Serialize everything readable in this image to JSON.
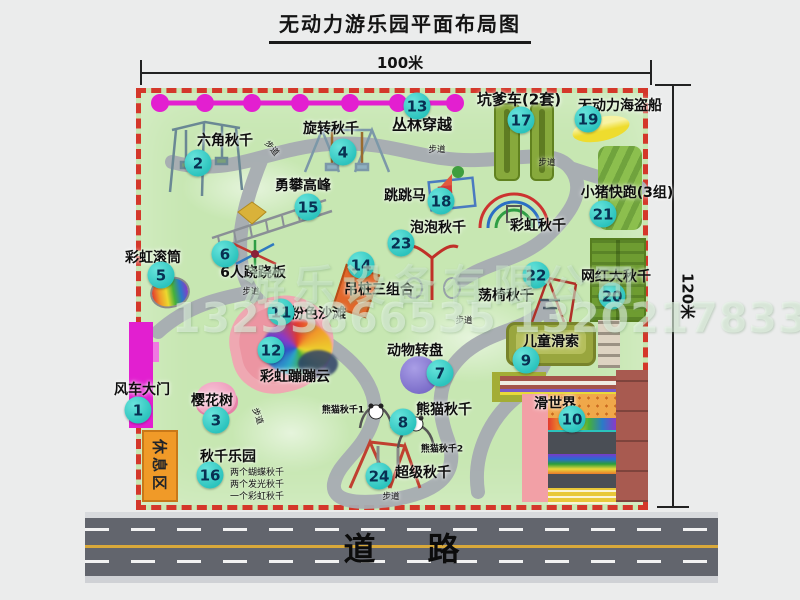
{
  "title": "无动力游乐园平面布局图",
  "dims": {
    "width": "100米",
    "height": "120米"
  },
  "road_label": "道路",
  "path_label": "步道",
  "rest_area": "休息区",
  "watermark": {
    "line1": "游乐设备有限公司",
    "line2": "13233866535 13202178333"
  },
  "labels_extra": {
    "rainbow_swing": "彩虹秋千",
    "panda1": "熊猫秋千1",
    "panda2": "熊猫秋千2"
  },
  "swing_park_notes": {
    "n1": "两个蝴蝶秋千",
    "n2": "两个发光秋千",
    "n3": "一个彩虹秋千"
  },
  "items": [
    {
      "num": "1",
      "label": "风车大门"
    },
    {
      "num": "2",
      "label": "六角秋千"
    },
    {
      "num": "3",
      "label": "樱花树"
    },
    {
      "num": "4",
      "label": "旋转秋千"
    },
    {
      "num": "5",
      "label": "彩虹滚筒"
    },
    {
      "num": "6",
      "label": "6人跷跷板"
    },
    {
      "num": "7",
      "label": "动物转盘"
    },
    {
      "num": "8",
      "label": "熊猫秋千"
    },
    {
      "num": "9",
      "label": "儿童滑索"
    },
    {
      "num": "10",
      "label": "滑世界"
    },
    {
      "num": "11",
      "label": "粉色沙滩"
    },
    {
      "num": "12",
      "label": "彩虹蹦蹦云"
    },
    {
      "num": "13",
      "label": "丛林穿越"
    },
    {
      "num": "14",
      "label": "吊桩三组合"
    },
    {
      "num": "15",
      "label": "勇攀高峰"
    },
    {
      "num": "16",
      "label": "秋千乐园"
    },
    {
      "num": "17",
      "label": "坑爹车(2套)"
    },
    {
      "num": "18",
      "label": "跳跳马"
    },
    {
      "num": "19",
      "label": "无动力海盗船"
    },
    {
      "num": "20",
      "label": "网红大秋千"
    },
    {
      "num": "21",
      "label": "小猪快跑(3组)"
    },
    {
      "num": "22",
      "label": "荡椅秋千"
    },
    {
      "num": "23",
      "label": "泡泡秋千"
    },
    {
      "num": "24",
      "label": "超级秋千"
    }
  ],
  "colors": {
    "park_fill": "#c7e7b2",
    "border_dash": "#d4372a",
    "badge": "#2bc3bd",
    "gate": "#e21fd0",
    "zipline": "#e31fd0",
    "road": "#62656d"
  }
}
